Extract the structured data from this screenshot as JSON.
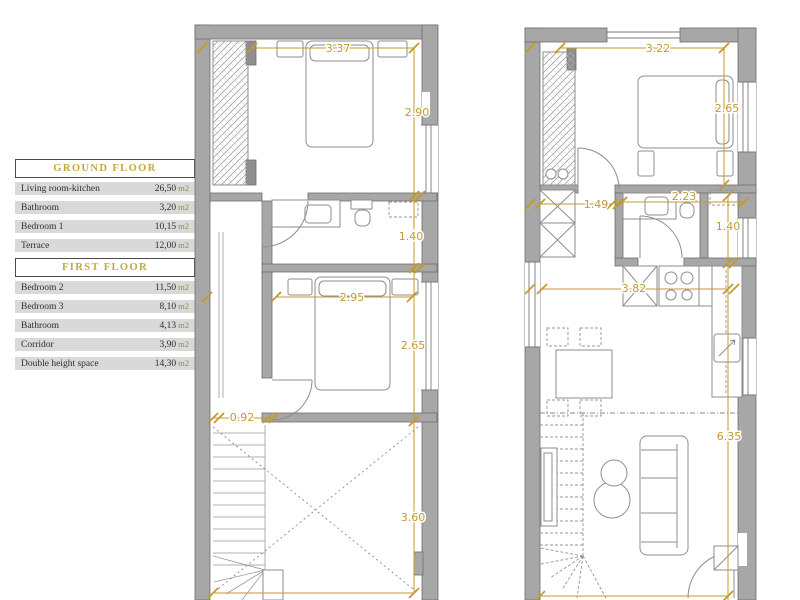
{
  "legend": {
    "sections": [
      {
        "title": "GROUND FLOOR",
        "rows": [
          {
            "label": "Living room-kitchen",
            "value": "26,50",
            "unit": "m2"
          },
          {
            "label": "Bathroom",
            "value": "3,20",
            "unit": "m2"
          },
          {
            "label": "Bedroom 1",
            "value": "10,15",
            "unit": "m2"
          },
          {
            "label": "Terrace",
            "value": "12,00",
            "unit": "m2"
          }
        ]
      },
      {
        "title": "FIRST FLOOR",
        "rows": [
          {
            "label": "Bedroom 2",
            "value": "11,50",
            "unit": "m2"
          },
          {
            "label": "Bedroom 3",
            "value": "8,10",
            "unit": "m2"
          },
          {
            "label": "Bathroom",
            "value": "4,13",
            "unit": "m2"
          },
          {
            "label": "Corridor",
            "value": "3,90",
            "unit": "m2"
          },
          {
            "label": "Double height space",
            "value": "14,30",
            "unit": "m2"
          }
        ]
      }
    ]
  },
  "plans": {
    "first_floor": {
      "dims": [
        "3.37",
        "2.90",
        "1.40",
        "2.95",
        "2.65",
        "0.92",
        "3.60"
      ]
    },
    "ground_floor": {
      "dims": [
        "3.22",
        "2.65",
        "1.49",
        "2.23",
        "1.40",
        "3.82",
        "6.35"
      ]
    }
  },
  "colors": {
    "dimension_gold": "#c49a2b",
    "legend_title_gold": "#c3a93d",
    "wall_gray": "#a7a7a7",
    "legend_row_bg": "#d9d9d9"
  }
}
